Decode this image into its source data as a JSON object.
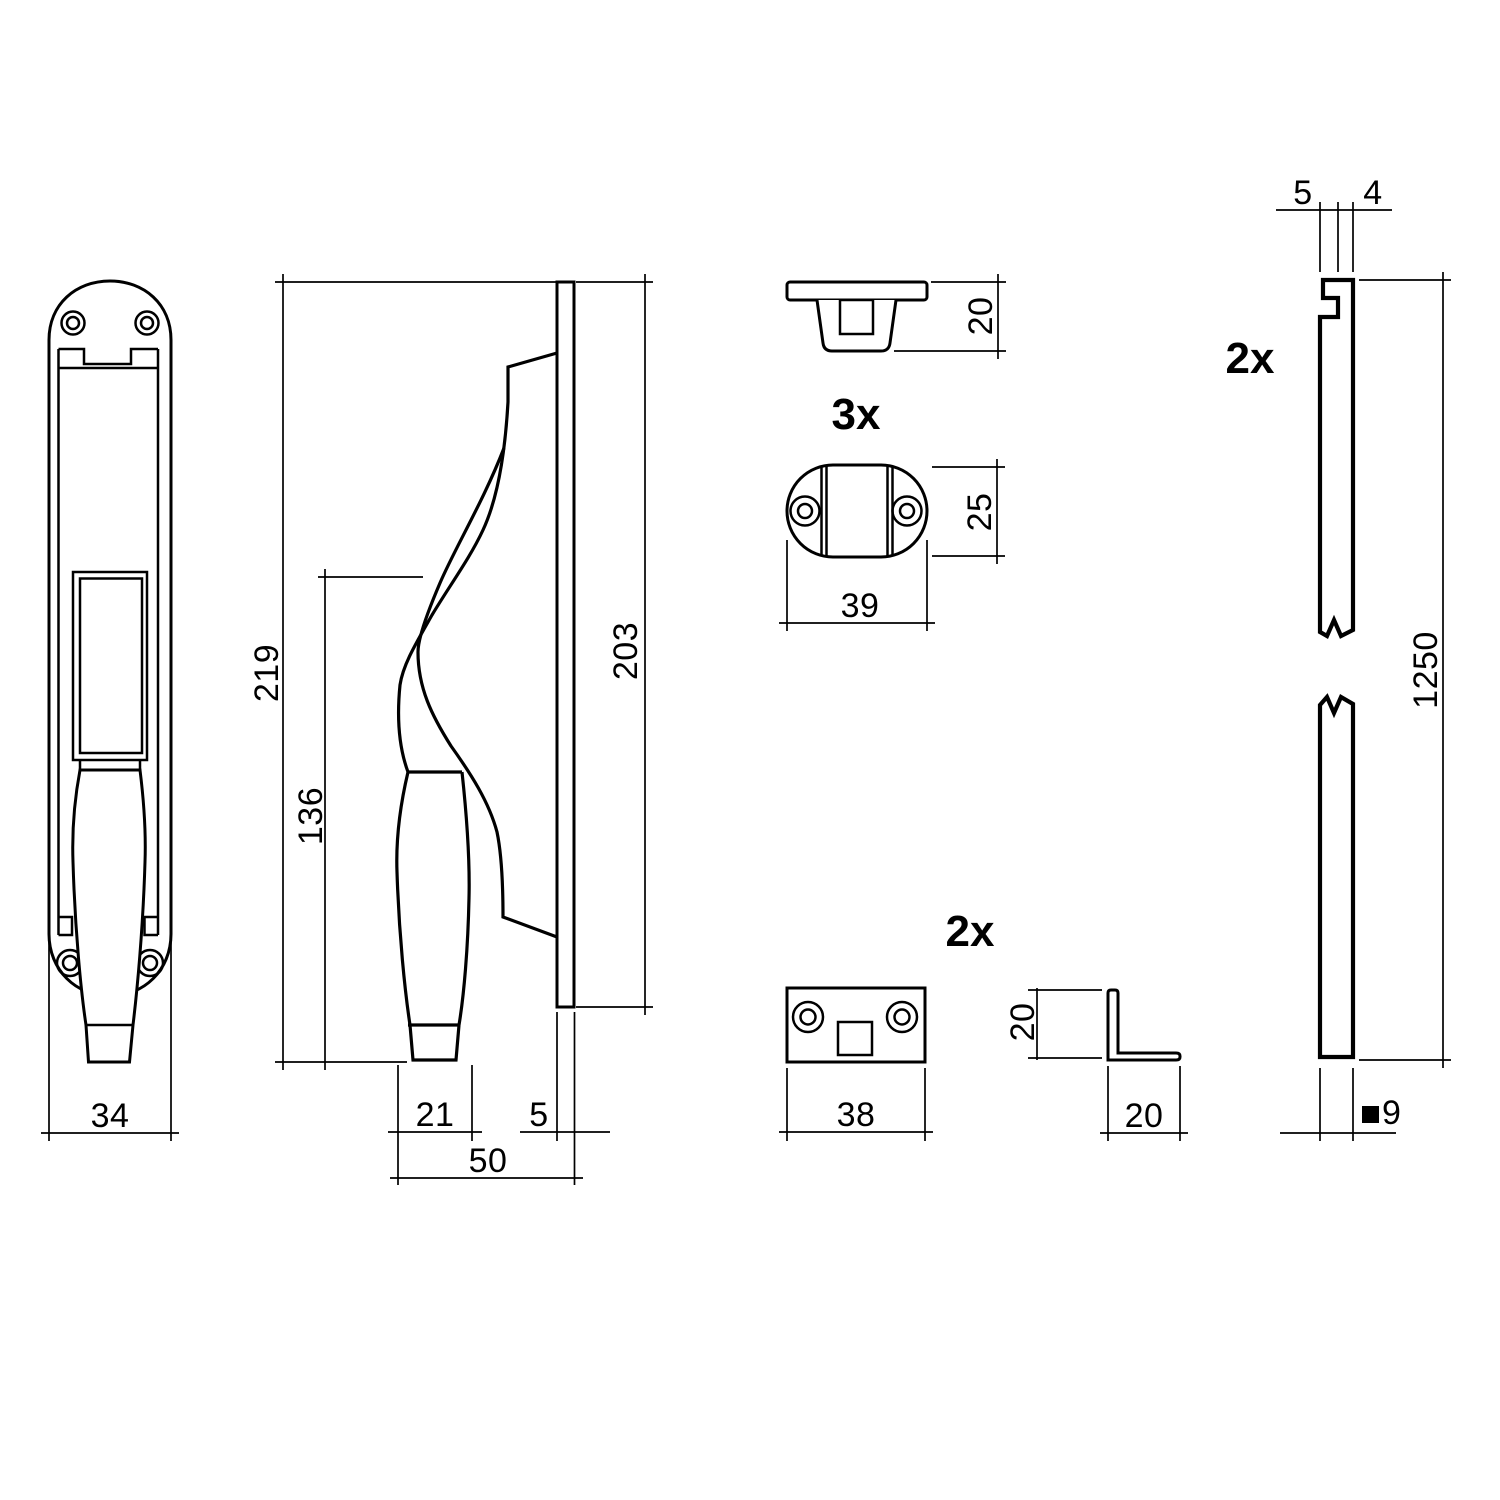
{
  "colors": {
    "line": "#000000",
    "background": "#ffffff"
  },
  "drawing": {
    "front_view": {
      "width": "34"
    },
    "side_view": {
      "total_height": "219",
      "grip_height": "136",
      "plate_height": "203",
      "grip_width": "21",
      "plate_thickness": "5",
      "total_depth": "50"
    },
    "t_guide": {
      "quantity": "3x",
      "height": "20"
    },
    "oval_guide": {
      "height": "25",
      "width": "39"
    },
    "striker_plate": {
      "quantity": "2x",
      "width": "38"
    },
    "corner_bracket": {
      "height": "20",
      "width": "20"
    },
    "rod": {
      "quantity": "2x",
      "top_left": "5",
      "top_right": "4",
      "length": "1250",
      "square_size": "9"
    }
  }
}
